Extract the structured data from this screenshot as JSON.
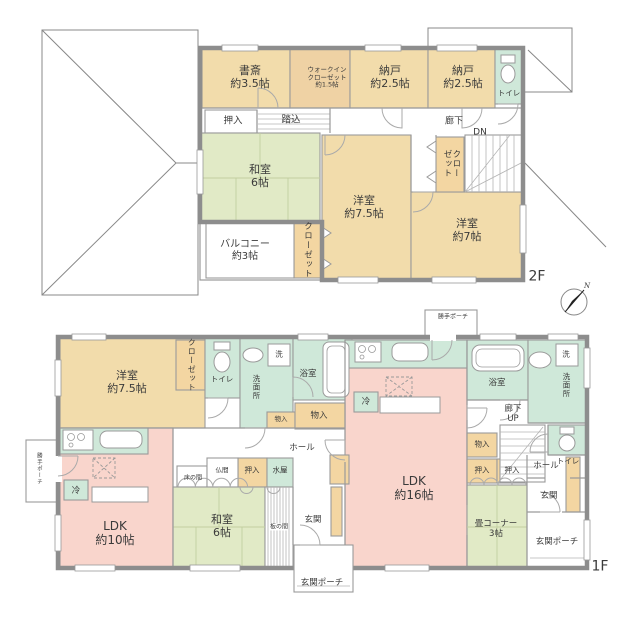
{
  "colors": {
    "tatami_green": "#e1eac6",
    "wood_room_cream": "#f2dcab",
    "ldk_pink": "#f9d5cc",
    "wet_area_teal": "#cfe8d9",
    "closet_tan": "#f3d6a2",
    "wall_gray": "#8d8d8d"
  },
  "floor2": {
    "label": "2F",
    "compass_n": "N",
    "rooms": {
      "study": "書斎\n約3.5帖",
      "walkin_closet": "ウォークイン\nクローゼット\n約1.5帖",
      "storage_a": "納戸\n約2.5帖",
      "storage_b": "納戸\n約2.5帖",
      "toilet": "トイレ",
      "corridor": "廊下",
      "stairs_dn": "DN",
      "oshiire": "押入",
      "fumikomi": "踏込",
      "washitsu": "和室\n6帖",
      "closet_left": "クローゼット",
      "closet_right": "クロー\nゼット",
      "yoshitsu_75": "洋室\n約7.5帖",
      "yoshitsu_7": "洋室\n約7帖",
      "balcony": "バルコニー\n約3帖"
    }
  },
  "floor1": {
    "label": "1F",
    "rooms": {
      "katte_porch_top": "勝手ポーチ",
      "katte_porch_left": "勝手ポーチ",
      "yoshitsu_75": "洋室\n約7.5帖",
      "closet": "クローゼット",
      "toilet_left": "トイレ",
      "senmenjo_left": "洗面所",
      "washer_left": "洗",
      "bath_left": "浴室",
      "storage_small": "物入",
      "storage_center": "物入",
      "fridge_right": "冷",
      "hall_center": "ホール",
      "ldk16": "LDK\n約16帖",
      "bath_right": "浴室",
      "washer_right": "洗",
      "senmenjo_right": "洗面所",
      "corridor_up": "廊下\nUP",
      "toilet_right": "トイレ",
      "storage_right": "物入",
      "oshiire_right_a": "押入",
      "oshiire_right_b": "押入",
      "hall_right": "ホール",
      "genkan_right": "玄関",
      "tatami_corner": "畳コーナー\n3帖",
      "porch_right": "玄関ポーチ",
      "fridge_left": "冷",
      "ldk10": "LDK\n約10帖",
      "tokonoma": "床の間",
      "butsuma": "仏間",
      "oshiire_center": "押入",
      "mizuya": "水屋",
      "washitsu": "和室\n6帖",
      "itanoma": "板の間",
      "genkan_center": "玄関",
      "porch_center": "玄関ポーチ"
    }
  }
}
